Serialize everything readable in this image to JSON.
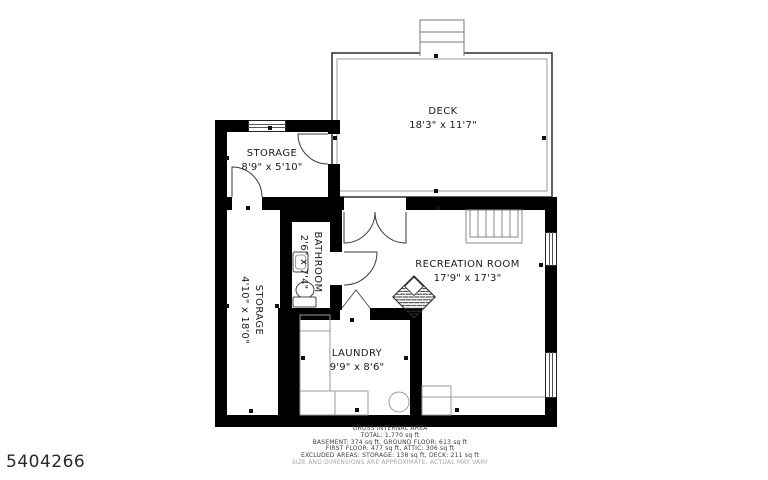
{
  "listing_id": "5404266",
  "rooms": {
    "deck": {
      "label": "DECK",
      "dims": "18'3\" x 11'7\""
    },
    "storage_upper": {
      "label": "STORAGE",
      "dims": "8'9\" x 5'10\""
    },
    "storage_left": {
      "label": "STORAGE",
      "dims": "4'10\" x 18'0\""
    },
    "bathroom": {
      "label": "BATHROOM",
      "dims": "2'6\" x 7'4\""
    },
    "recreation": {
      "label": "RECREATION ROOM",
      "dims": "17'9\" x 17'3\""
    },
    "laundry": {
      "label": "LAUNDRY",
      "dims": "9'9\" x 8'6\""
    }
  },
  "area_summary": {
    "heading": "GROSS INTERNAL AREA",
    "total": "TOTAL: 1,770 sq ft",
    "line_basement_ground": "BASEMENT: 374 sq ft, GROUND FLOOR: 613 sq ft",
    "line_first_attic": "FIRST FLOOR: 477 sq ft, ATTIC: 306 sq ft",
    "line_excluded": "EXCLUDED AREAS: STORAGE: 138 sq ft, DECK: 211 sq ft",
    "disclaimer": "SIZE AND DIMENSIONS ARE APPROXIMATE, ACTUAL MAY VARY"
  },
  "colors": {
    "wall": "#000000",
    "thin_line": "#8a8a8a",
    "text": "#1c1c1c",
    "muted": "#a9a9a9"
  }
}
